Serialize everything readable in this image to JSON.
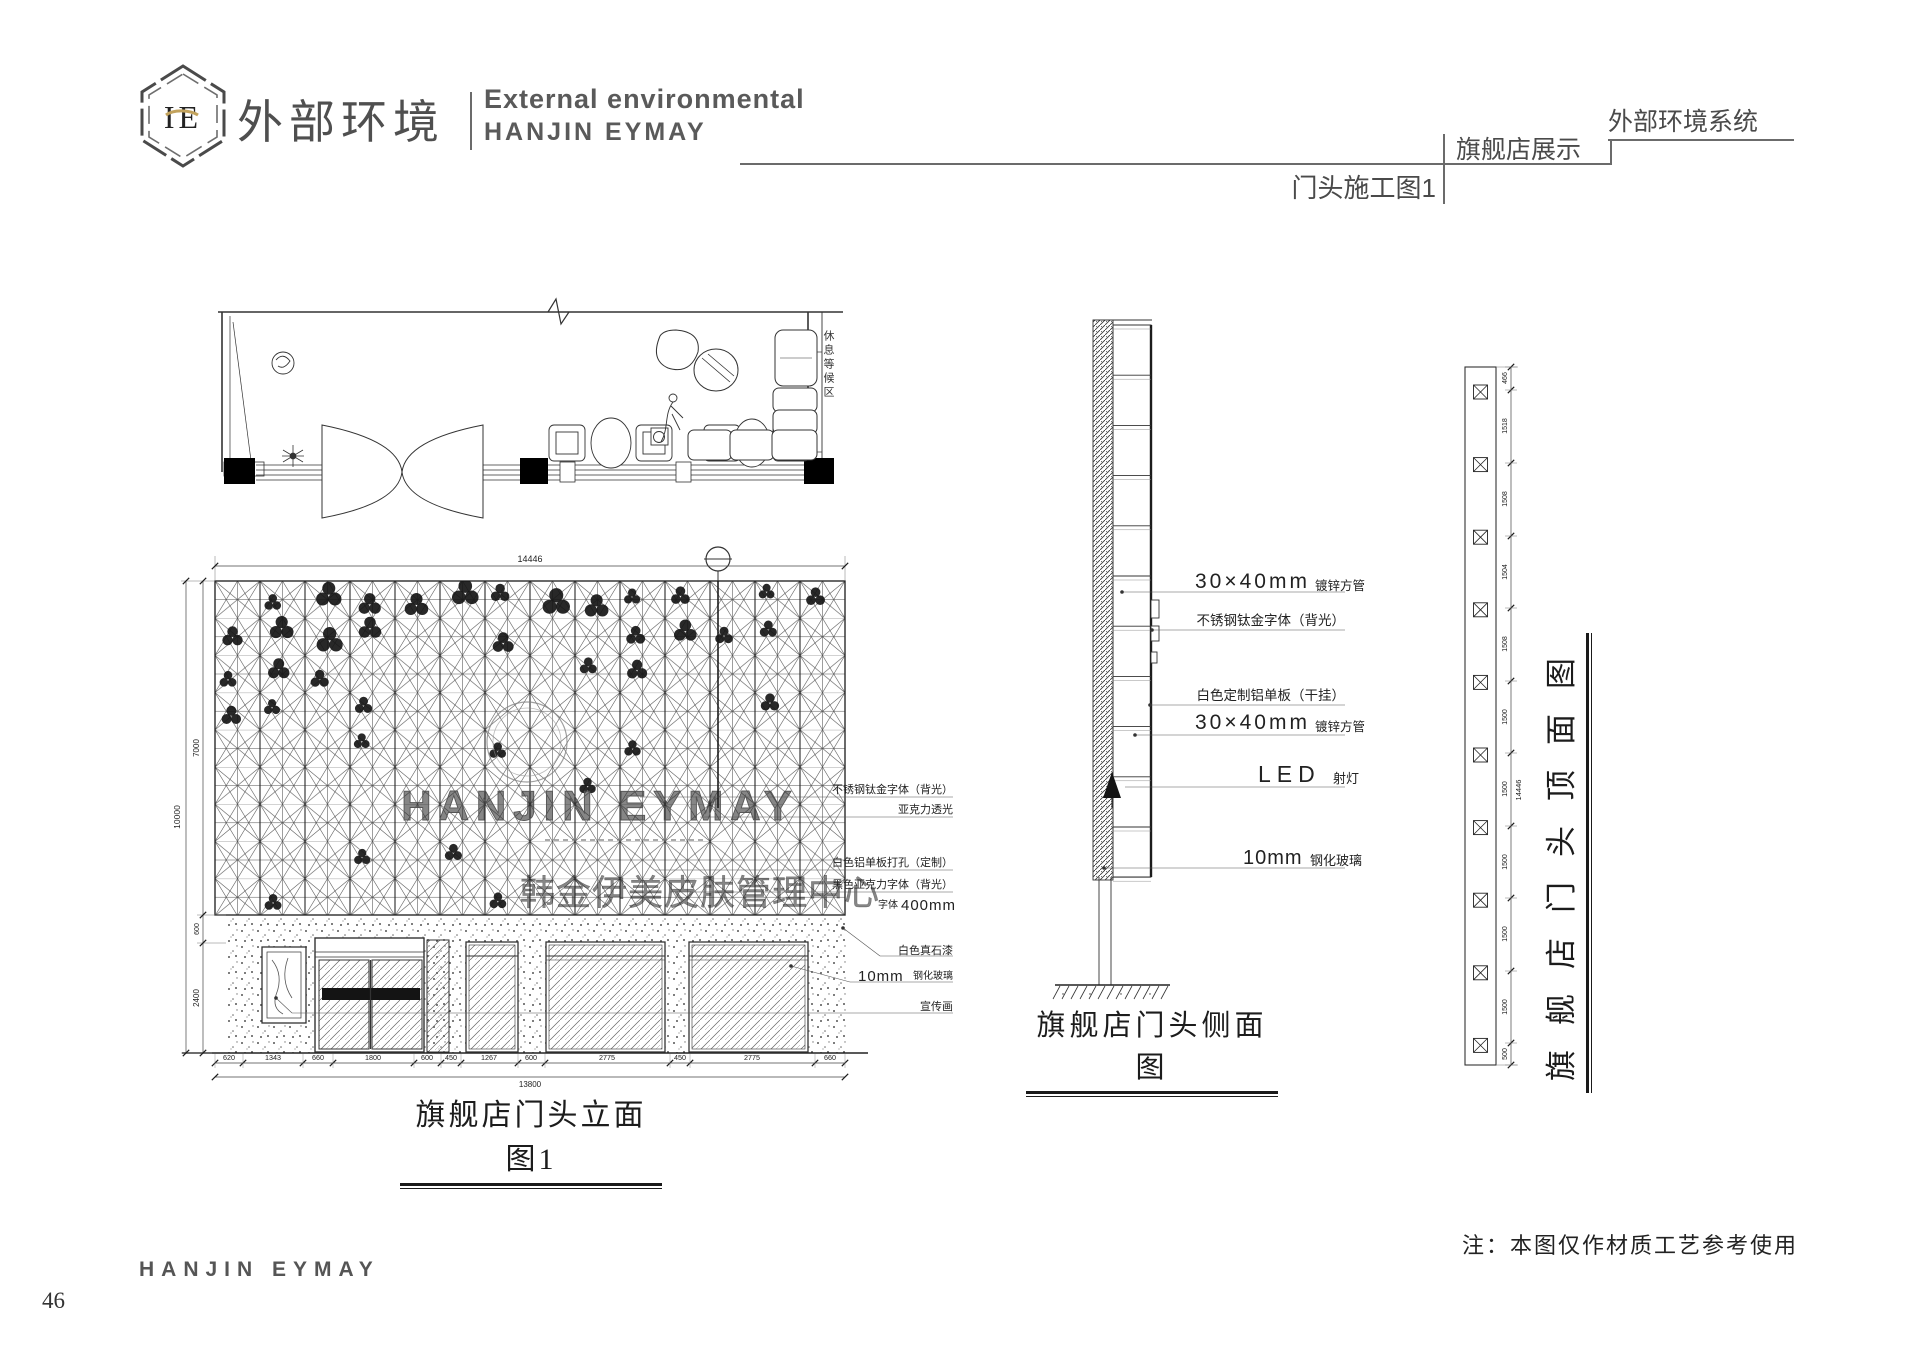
{
  "header": {
    "logo_monogram": "IE",
    "logo_cn": "外部环境",
    "logo_en1": "External environmental",
    "logo_en2": "HANJIN EYMAY",
    "crumb1": "外部环境系统",
    "crumb2": "旗舰店展示",
    "crumb3": "门头施工图1"
  },
  "plan": {
    "area_label": "休息等候区"
  },
  "elevation": {
    "title": "旗舰店门头立面图1",
    "watermark_en": "HANJIN EYMAY",
    "watermark_cn": "韩金伊美皮肤管理中心",
    "dim_top": "14446",
    "dim_total_height": "10000",
    "dims_left": [
      "7000",
      "600",
      "2400"
    ],
    "dims_bottom": [
      "620",
      "1343",
      "660",
      "1800",
      "600",
      "450",
      "1267",
      "600",
      "2775",
      "450",
      "2775",
      "660"
    ],
    "dim_bottom_total": "13800",
    "labels": {
      "steel_font": "不锈钢钛金字体（背光）",
      "acrylic": "亚克力透光",
      "alu_panel": "白色铝单板打孔（定制）",
      "black_acrylic": "黑色亚克力字体（背光）",
      "font_prefix": "字体",
      "font_size": "400mm",
      "stone_paint": "白色真石漆",
      "glass_big": "10mm",
      "glass_small": "钢化玻璃",
      "poster": "宣传画"
    }
  },
  "side": {
    "title": "旗舰店门头侧面图",
    "labels": {
      "tube_big": "30×40mm",
      "tube_small": "镀锌方管",
      "steel_font": "不锈钢钛金字体（背光）",
      "alu": "白色定制铝单板（干挂）",
      "tube2_big": "30×40mm",
      "tube2_small": "镀锌方管",
      "led_big": "LED",
      "led_small": "射灯",
      "glass_big": "10mm",
      "glass_small": "钢化玻璃"
    }
  },
  "top_view": {
    "title": "旗舰店门头顶面图",
    "dim_total": "14446",
    "dims": [
      "466",
      "1518",
      "1508",
      "1504",
      "1508",
      "1500",
      "1500",
      "1500",
      "1500",
      "1500",
      "500"
    ]
  },
  "footer": {
    "brand": "HANJIN EYMAY",
    "page": "46",
    "note": "注：本图仅作材质工艺参考使用"
  }
}
